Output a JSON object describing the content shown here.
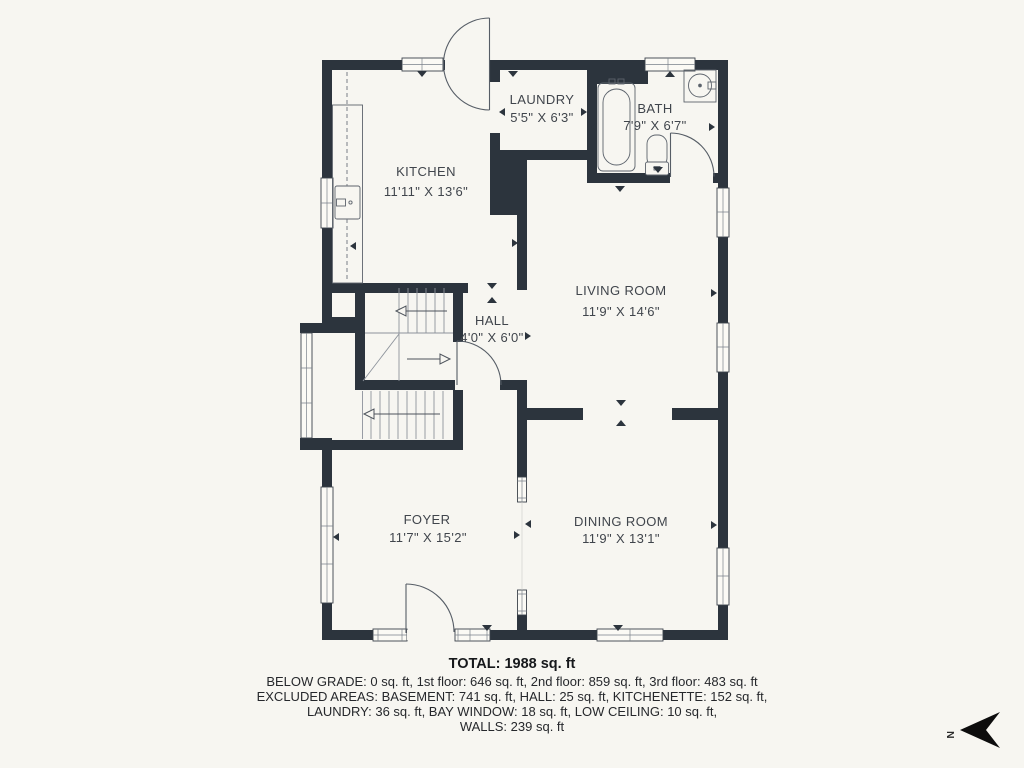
{
  "floor_plan": {
    "rooms": [
      {
        "id": "kitchen",
        "name": "KITCHEN",
        "dimensions": "11'11\" X 13'6\""
      },
      {
        "id": "laundry",
        "name": "LAUNDRY",
        "dimensions": "5'5\" X 6'3\""
      },
      {
        "id": "bath",
        "name": "BATH",
        "dimensions": "7'9\" X 6'7\""
      },
      {
        "id": "living-room",
        "name": "LIVING ROOM",
        "dimensions": "11'9\" X 14'6\""
      },
      {
        "id": "hall",
        "name": "HALL",
        "dimensions": "4'0\" X 6'0\""
      },
      {
        "id": "foyer",
        "name": "FOYER",
        "dimensions": "11'7\" X 15'2\""
      },
      {
        "id": "dining-room",
        "name": "DINING ROOM",
        "dimensions": "11'9\" X 13'1\""
      }
    ],
    "summary": {
      "total": "TOTAL: 1988 sq. ft",
      "floors": "BELOW GRADE: 0 sq. ft, 1st floor: 646 sq. ft, 2nd floor: 859 sq. ft, 3rd floor: 483 sq. ft",
      "excluded_1": "EXCLUDED AREAS: BASEMENT: 741 sq. ft, HALL: 25 sq. ft, KITCHENETTE: 152 sq. ft,",
      "excluded_2": "LAUNDRY: 36 sq. ft, BAY WINDOW: 18 sq. ft, LOW CEILING: 10 sq. ft,",
      "walls": "WALLS: 239 sq. ft"
    },
    "compass": {
      "direction_label": "N"
    },
    "colors": {
      "wall": "#2c343d",
      "background": "#f7f6f1",
      "fixture_line": "#5c636c",
      "stair_line": "#8d939b",
      "label_text": "#40454c",
      "summary_text": "#26282c"
    }
  }
}
